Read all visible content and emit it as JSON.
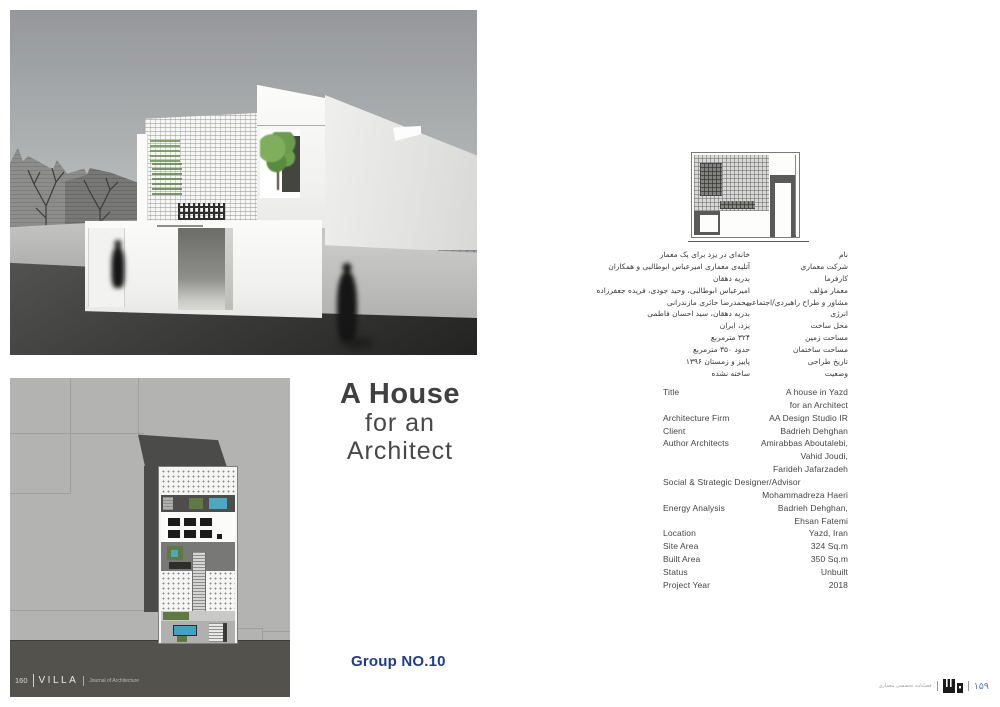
{
  "colors": {
    "accent_blue": "#1c3b94",
    "page_number_blue": "#5b79b4"
  },
  "title_block": {
    "line1": "A House",
    "line2": "for an",
    "line3": "Architect"
  },
  "group_label": "Group NO.10",
  "persian_details": {
    "rows": [
      {
        "label": "نام",
        "value": "خانه‌ای در یزد برای یک معمار"
      },
      {
        "label": "شرکت معماری",
        "value": "آتلیه‌ی معماری امیرعباس ابوطالبی و همکاران"
      },
      {
        "label": "کارفرما",
        "value": "بدریه دهقان"
      },
      {
        "label": "معمار مؤلف",
        "value": "امیرعباس ابوطالبی، وحید جودی، فریده جعفرزاده"
      },
      {
        "label": "مشاور و طراح راهبردی/اجتماعی",
        "value": "محمدرضا حائری مازندرانی"
      },
      {
        "label": "انرژی",
        "value": "بدریه دهقان، سید احسان فاطمی"
      },
      {
        "label": "محل ساخت",
        "value": "یزد، ایران"
      },
      {
        "label": "مساحت زمین",
        "value": "۳۲۴ مترمربع"
      },
      {
        "label": "مساحت ساختمان",
        "value": "حدود ۳۵۰ مترمربع"
      },
      {
        "label": "تاریخ طراحی",
        "value": "پاییز و زمستان ۱۳۹۶"
      },
      {
        "label": "وضعیت",
        "value": "ساخته نشده"
      }
    ]
  },
  "english_details": {
    "rows": [
      {
        "label": "Title",
        "value": "A house in Yazd"
      },
      {
        "label": "",
        "value": "for an Architect"
      },
      {
        "label": "Architecture Firm",
        "value": "AA Design Studio IR"
      },
      {
        "label": "Client",
        "value": "Badrieh Dehghan"
      },
      {
        "label": "Author Architects",
        "value": "Amirabbas Aboutalebi,"
      },
      {
        "label": "",
        "value": "Vahid Joudi,"
      },
      {
        "label": "",
        "value": "Farideh Jafarzadeh"
      },
      {
        "label": "Social & Strategic Designer/Advisor",
        "value": ""
      },
      {
        "label": "",
        "value": "Mohammadreza Haeri"
      },
      {
        "label": "Energy Analysis",
        "value": "Badrieh Dehghan,"
      },
      {
        "label": "",
        "value": "Ehsan Fatemi"
      },
      {
        "label": "Location",
        "value": "Yazd, Iran"
      },
      {
        "label": "Site Area",
        "value": "324 Sq.m"
      },
      {
        "label": "Built Area",
        "value": "350 Sq.m"
      },
      {
        "label": "Status",
        "value": "Unbuilt"
      },
      {
        "label": "Project Year",
        "value": "2018"
      }
    ]
  },
  "plan_footer": {
    "page_number": "160",
    "journal_name": "VILLA",
    "journal_subtitle": "Journal of Architecture"
  },
  "page_footer": {
    "journal_caption": "فصلنامه تخصصی معماری",
    "logo_icon": "villa-logo",
    "page_number": "۱۵۹"
  }
}
